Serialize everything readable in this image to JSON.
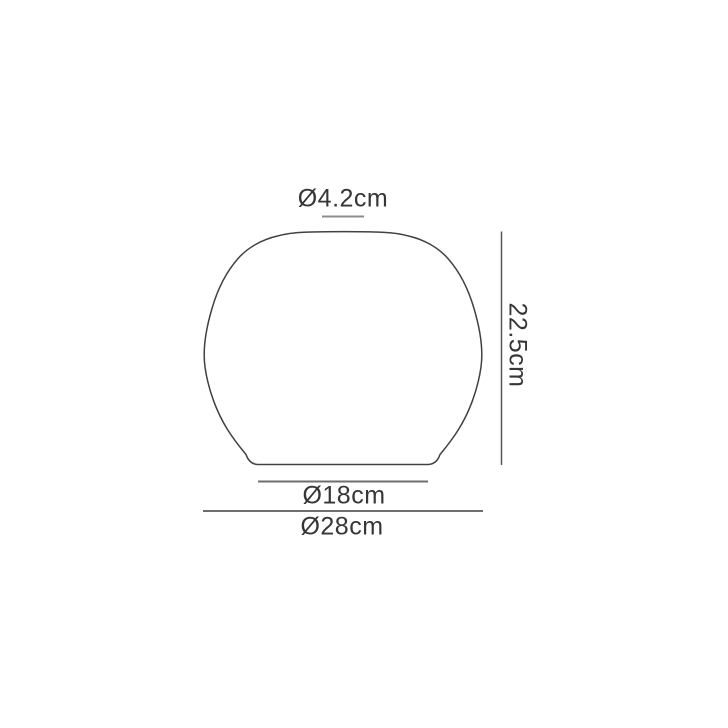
{
  "diagram": {
    "type": "product-dimension-drawing",
    "subject": "lampshade-profile",
    "dimensions": {
      "top_diameter": {
        "label": "Ø4.2cm",
        "value_cm": 4.2
      },
      "height": {
        "label": "22.5cm",
        "value_cm": 22.5
      },
      "base_inner_diameter": {
        "label": "Ø18cm",
        "value_cm": 18
      },
      "base_outer_diameter": {
        "label": "Ø28cm",
        "value_cm": 28
      }
    },
    "colors": {
      "background": "#ffffff",
      "outline": "#414141",
      "text": "#363636",
      "dim_line_light": "#8c8c8c",
      "dim_line_medium": "#6e6e6e",
      "dim_line_dark": "#555555"
    }
  }
}
